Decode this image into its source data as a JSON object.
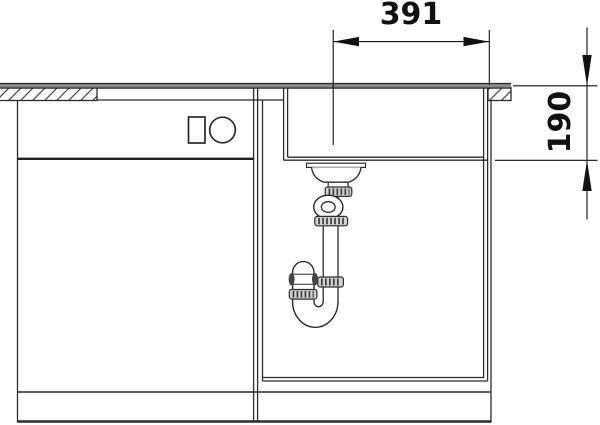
{
  "dimensions": {
    "width": {
      "label": "391"
    },
    "depth": {
      "label": "190"
    }
  },
  "colors": {
    "line": "#2b2b2b",
    "dimension": "#111111",
    "counter_band": "#8a8a8a",
    "fitting_fill": "#d2d2d2",
    "background": "#ffffff"
  },
  "parts": [
    "countertop-left-section",
    "countertop-right-section",
    "sink-rim",
    "sink-bowl",
    "basket-strainer",
    "drain-tailpipe",
    "overflow-ring",
    "siphon-s-trap",
    "pipe-nut",
    "base-cabinet",
    "cabinet-divider",
    "sink-base-interior",
    "control-rectangle",
    "control-knob",
    "dimension-width",
    "dimension-depth"
  ]
}
